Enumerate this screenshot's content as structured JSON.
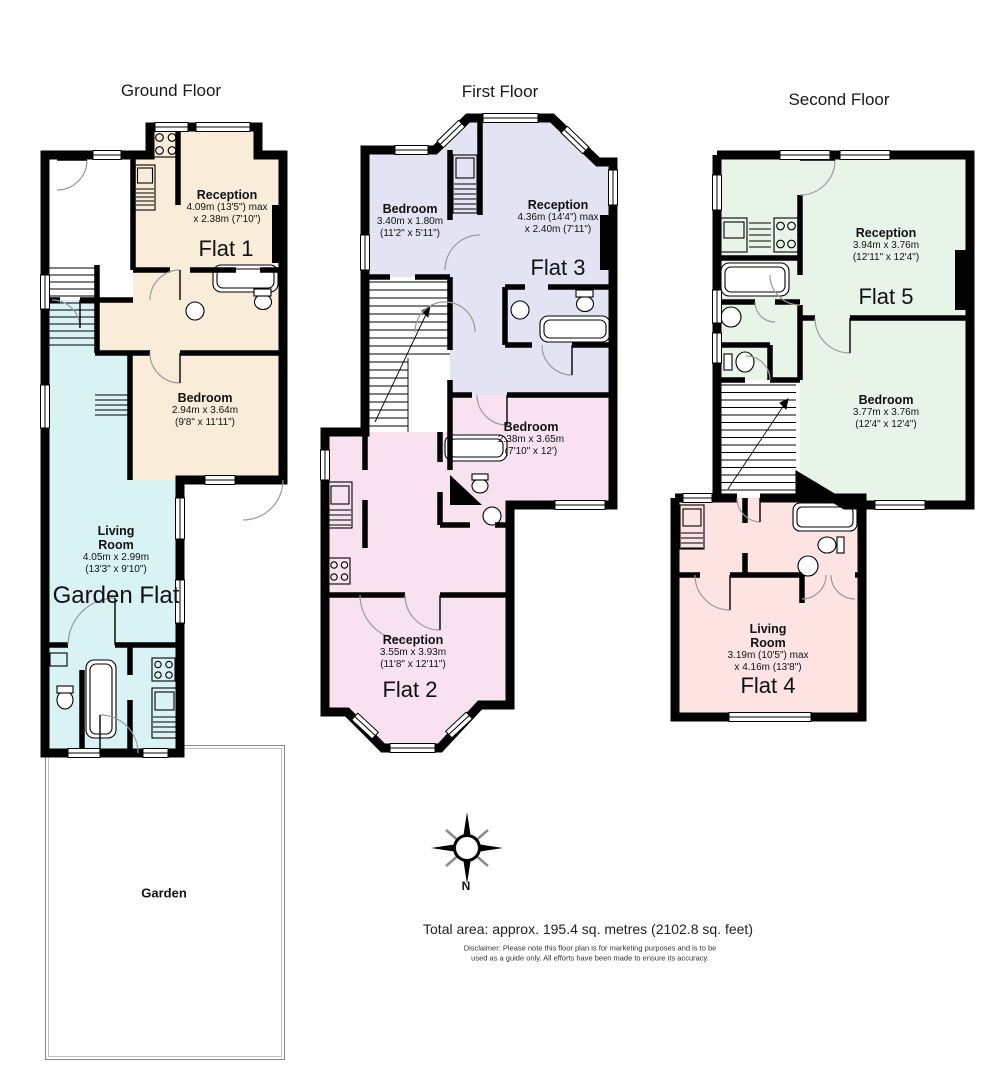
{
  "colors": {
    "flat1": "#f9ecd9",
    "garden_flat": "#d9f2f4",
    "flat3": "#e4e3f3",
    "flat2": "#f8e2f0",
    "flat5": "#e9f4e8",
    "flat4": "#fde3e2",
    "wall": "#000000",
    "door_arc": "#9a9a9a"
  },
  "floors": [
    {
      "title": "Ground Floor",
      "rooms": [
        {
          "name": "Reception",
          "dim1": "4.09m (13'5\") max",
          "dim2": "x 2.38m (7'10\")"
        },
        {
          "name": "Bedroom",
          "dim1": "2.94m x 3.64m",
          "dim2": "(9'8\" x 11'11\")"
        },
        {
          "name": "Living Room",
          "dim1": "4.05m x 2.99m",
          "dim2": "(13'3\" x 9'10\")"
        }
      ],
      "flats": [
        {
          "label": "Flat 1"
        },
        {
          "label": "Garden Flat"
        }
      ],
      "garden_label": "Garden"
    },
    {
      "title": "First Floor",
      "rooms": [
        {
          "name": "Bedroom",
          "dim1": "3.40m x 1.80m",
          "dim2": "(11'2\" x 5'11\")"
        },
        {
          "name": "Reception",
          "dim1": "4.36m (14'4\") max",
          "dim2": "x 2.40m (7'11\")"
        },
        {
          "name": "Bedroom",
          "dim1": "2.38m x 3.65m",
          "dim2": "(7'10\" x 12')"
        },
        {
          "name": "Reception",
          "dim1": "3.55m x 3.93m",
          "dim2": "(11'8\" x 12'11\")"
        }
      ],
      "flats": [
        {
          "label": "Flat 3"
        },
        {
          "label": "Flat 2"
        }
      ]
    },
    {
      "title": "Second Floor",
      "rooms": [
        {
          "name": "Reception",
          "dim1": "3.94m x 3.76m",
          "dim2": "(12'11\" x 12'4\")"
        },
        {
          "name": "Bedroom",
          "dim1": "3.77m x 3.76m",
          "dim2": "(12'4\" x 12'4\")"
        },
        {
          "name": "Living Room",
          "dim1": "3.19m (10'5\") max",
          "dim2": "x 4.16m (13'8\")"
        }
      ],
      "flats": [
        {
          "label": "Flat 5"
        },
        {
          "label": "Flat 4"
        }
      ]
    }
  ],
  "compass": {
    "north_label": "N"
  },
  "footer": {
    "total_area": "Total area: approx. 195.4 sq. metres (2102.8 sq. feet)",
    "disclaimer_line1": "Disclaimer: Please note this floor plan is for marketing purposes and is to be",
    "disclaimer_line2": "used as a guide only. All efforts have been made to ensure its accuracy."
  }
}
